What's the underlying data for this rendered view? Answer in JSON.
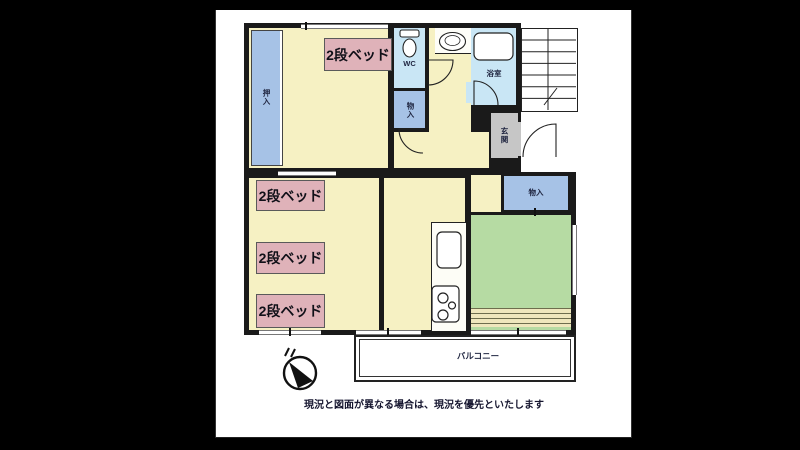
{
  "plan": {
    "rooms": {
      "oshiire_label": "押入",
      "wc_label": "WC",
      "storage1_label": "物入",
      "bath_label": "浴室",
      "genkan_label": "玄関",
      "storage2_label": "物入",
      "balcony_label": "バルコニー"
    },
    "bed_labels": [
      "2段ベッド",
      "2段ベッド",
      "2段ベッド",
      "2段ベッド"
    ],
    "compass_label": "N",
    "disclaimer": "現況と図面が異なる場合は、現況を優先といたします",
    "colors": {
      "letterbox_bg": "#000000",
      "document_bg": "#ffffff",
      "wall": "#1a1a1a",
      "room_yellow": "#f6f1c3",
      "closet_blue": "#a6c2e6",
      "wet_lightblue": "#c9e6f5",
      "tatami_green": "#b6dba3",
      "genkan_gray": "#c6c6c6",
      "bed_label_pink": "#dfb2b9",
      "tatami_edge_beige": "#efe7bd",
      "label_text": "#1f2540"
    }
  }
}
